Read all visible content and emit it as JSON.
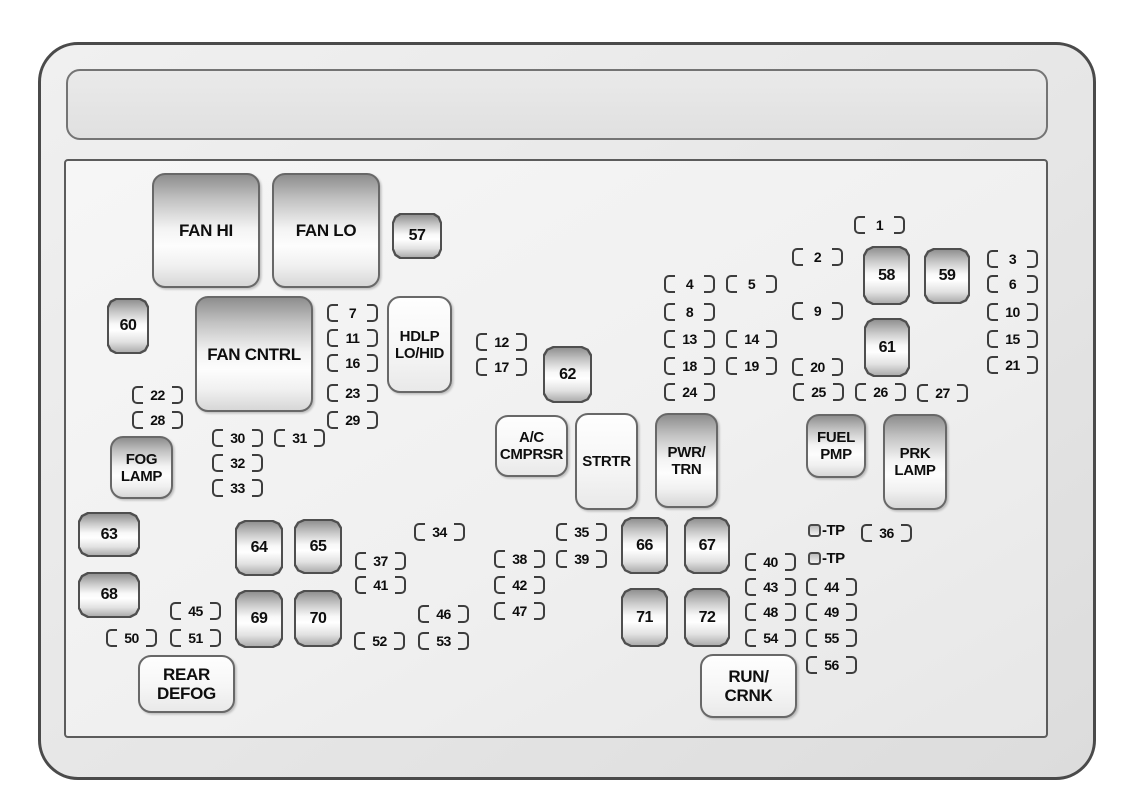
{
  "diagram": {
    "colors": {
      "shell_border": "#4a4a4a",
      "panel_border": "#5c5c5c",
      "bracket": "#3d3d3d",
      "text": "#0e0e0e",
      "shell_fill": "#e6e6e6",
      "panel_fill": "#f0f0f0"
    },
    "relays": [
      {
        "id": "fan-hi",
        "label_lines": [
          "FAN HI"
        ],
        "fill": "gradient",
        "text_size": "lg",
        "x": 152,
        "y": 173,
        "w": 108,
        "h": 115
      },
      {
        "id": "fan-lo",
        "label_lines": [
          "FAN LO"
        ],
        "fill": "gradient",
        "text_size": "lg",
        "x": 272,
        "y": 173,
        "w": 108,
        "h": 115
      },
      {
        "id": "fan-cntrl",
        "label_lines": [
          "FAN CNTRL"
        ],
        "fill": "gradient",
        "text_size": "lg",
        "x": 195,
        "y": 296,
        "w": 118,
        "h": 116
      },
      {
        "id": "hdlp-lo-hid",
        "label_lines": [
          "HDLP",
          "LO/HID"
        ],
        "fill": "light",
        "text_size": "md",
        "x": 387,
        "y": 296,
        "w": 65,
        "h": 97
      },
      {
        "id": "fog-lamp",
        "label_lines": [
          "FOG",
          "LAMP"
        ],
        "fill": "gradient",
        "text_size": "md",
        "x": 110,
        "y": 436,
        "w": 63,
        "h": 63
      },
      {
        "id": "ac-cmprsr",
        "label_lines": [
          "A/C",
          "CMPRSR"
        ],
        "fill": "light",
        "text_size": "md",
        "x": 495,
        "y": 415,
        "w": 73,
        "h": 62
      },
      {
        "id": "strtr",
        "label_lines": [
          "STRTR"
        ],
        "fill": "light",
        "text_size": "md",
        "x": 575,
        "y": 413,
        "w": 63,
        "h": 97
      },
      {
        "id": "pwr-trn",
        "label_lines": [
          "PWR/",
          "TRN"
        ],
        "fill": "gradient",
        "text_size": "md",
        "x": 655,
        "y": 413,
        "w": 63,
        "h": 95
      },
      {
        "id": "fuel-pmp",
        "label_lines": [
          "FUEL",
          "PMP"
        ],
        "fill": "gradient",
        "text_size": "md",
        "x": 806,
        "y": 414,
        "w": 60,
        "h": 64
      },
      {
        "id": "prk-lamp",
        "label_lines": [
          "PRK",
          "LAMP"
        ],
        "fill": "gradient",
        "text_size": "md",
        "x": 883,
        "y": 414,
        "w": 64,
        "h": 96
      },
      {
        "id": "rear-defog",
        "label_lines": [
          "REAR",
          "DEFOG"
        ],
        "fill": "light",
        "text_size": "lg",
        "x": 138,
        "y": 655,
        "w": 97,
        "h": 58
      },
      {
        "id": "run-crnk",
        "label_lines": [
          "RUN/",
          "CRNK"
        ],
        "fill": "light",
        "text_size": "lg",
        "x": 700,
        "y": 654,
        "w": 97,
        "h": 64
      }
    ],
    "fuses": [
      {
        "number": "57",
        "orientation": "h",
        "x": 392,
        "y": 213,
        "w": 50,
        "h": 46
      },
      {
        "number": "58",
        "orientation": "v",
        "x": 863,
        "y": 246,
        "w": 47,
        "h": 59
      },
      {
        "number": "59",
        "orientation": "v",
        "x": 924,
        "y": 248,
        "w": 46,
        "h": 56
      },
      {
        "number": "60",
        "orientation": "v",
        "x": 107,
        "y": 298,
        "w": 42,
        "h": 56
      },
      {
        "number": "61",
        "orientation": "v",
        "x": 864,
        "y": 318,
        "w": 46,
        "h": 59
      },
      {
        "number": "62",
        "orientation": "v",
        "x": 543,
        "y": 346,
        "w": 49,
        "h": 57
      },
      {
        "number": "63",
        "orientation": "h",
        "x": 78,
        "y": 512,
        "w": 62,
        "h": 45
      },
      {
        "number": "64",
        "orientation": "v",
        "x": 235,
        "y": 520,
        "w": 48,
        "h": 56
      },
      {
        "number": "65",
        "orientation": "v",
        "x": 294,
        "y": 519,
        "w": 48,
        "h": 55
      },
      {
        "number": "66",
        "orientation": "v",
        "x": 621,
        "y": 517,
        "w": 47,
        "h": 57
      },
      {
        "number": "67",
        "orientation": "v",
        "x": 684,
        "y": 517,
        "w": 46,
        "h": 57
      },
      {
        "number": "68",
        "orientation": "h",
        "x": 78,
        "y": 572,
        "w": 62,
        "h": 46
      },
      {
        "number": "69",
        "orientation": "v",
        "x": 235,
        "y": 590,
        "w": 48,
        "h": 58
      },
      {
        "number": "70",
        "orientation": "v",
        "x": 294,
        "y": 590,
        "w": 48,
        "h": 57
      },
      {
        "number": "71",
        "orientation": "v",
        "x": 621,
        "y": 588,
        "w": 47,
        "h": 59
      },
      {
        "number": "72",
        "orientation": "v",
        "x": 684,
        "y": 588,
        "w": 46,
        "h": 59
      }
    ],
    "slots": [
      {
        "n": "1",
        "x": 854,
        "y": 216
      },
      {
        "n": "2",
        "x": 792,
        "y": 248
      },
      {
        "n": "3",
        "x": 987,
        "y": 250
      },
      {
        "n": "4",
        "x": 664,
        "y": 275
      },
      {
        "n": "5",
        "x": 726,
        "y": 275
      },
      {
        "n": "6",
        "x": 987,
        "y": 275
      },
      {
        "n": "7",
        "x": 327,
        "y": 304
      },
      {
        "n": "8",
        "x": 664,
        "y": 303
      },
      {
        "n": "9",
        "x": 792,
        "y": 302
      },
      {
        "n": "10",
        "x": 987,
        "y": 303
      },
      {
        "n": "11",
        "x": 327,
        "y": 329
      },
      {
        "n": "12",
        "x": 476,
        "y": 333
      },
      {
        "n": "13",
        "x": 664,
        "y": 330
      },
      {
        "n": "14",
        "x": 726,
        "y": 330
      },
      {
        "n": "15",
        "x": 987,
        "y": 330
      },
      {
        "n": "16",
        "x": 327,
        "y": 354
      },
      {
        "n": "17",
        "x": 476,
        "y": 358
      },
      {
        "n": "18",
        "x": 664,
        "y": 357
      },
      {
        "n": "19",
        "x": 726,
        "y": 357
      },
      {
        "n": "20",
        "x": 792,
        "y": 358
      },
      {
        "n": "21",
        "x": 987,
        "y": 356
      },
      {
        "n": "22",
        "x": 132,
        "y": 386
      },
      {
        "n": "23",
        "x": 327,
        "y": 384
      },
      {
        "n": "24",
        "x": 664,
        "y": 383
      },
      {
        "n": "25",
        "x": 793,
        "y": 383
      },
      {
        "n": "26",
        "x": 855,
        "y": 383
      },
      {
        "n": "27",
        "x": 917,
        "y": 384
      },
      {
        "n": "28",
        "x": 132,
        "y": 411
      },
      {
        "n": "29",
        "x": 327,
        "y": 411
      },
      {
        "n": "30",
        "x": 212,
        "y": 429
      },
      {
        "n": "31",
        "x": 274,
        "y": 429
      },
      {
        "n": "32",
        "x": 212,
        "y": 454
      },
      {
        "n": "33",
        "x": 212,
        "y": 479
      },
      {
        "n": "34",
        "x": 414,
        "y": 523
      },
      {
        "n": "35",
        "x": 556,
        "y": 523
      },
      {
        "n": "36",
        "x": 861,
        "y": 524
      },
      {
        "n": "37",
        "x": 355,
        "y": 552
      },
      {
        "n": "38",
        "x": 494,
        "y": 550
      },
      {
        "n": "39",
        "x": 556,
        "y": 550
      },
      {
        "n": "40",
        "x": 745,
        "y": 553
      },
      {
        "n": "41",
        "x": 355,
        "y": 576
      },
      {
        "n": "42",
        "x": 494,
        "y": 576
      },
      {
        "n": "43",
        "x": 745,
        "y": 578
      },
      {
        "n": "44",
        "x": 806,
        "y": 578
      },
      {
        "n": "45",
        "x": 170,
        "y": 602
      },
      {
        "n": "46",
        "x": 418,
        "y": 605
      },
      {
        "n": "47",
        "x": 494,
        "y": 602
      },
      {
        "n": "48",
        "x": 745,
        "y": 603
      },
      {
        "n": "49",
        "x": 806,
        "y": 603
      },
      {
        "n": "50",
        "x": 106,
        "y": 629
      },
      {
        "n": "51",
        "x": 170,
        "y": 629
      },
      {
        "n": "52",
        "x": 354,
        "y": 632
      },
      {
        "n": "53",
        "x": 418,
        "y": 632
      },
      {
        "n": "54",
        "x": 745,
        "y": 629
      },
      {
        "n": "55",
        "x": 806,
        "y": 629
      },
      {
        "n": "56",
        "x": 806,
        "y": 656
      }
    ],
    "tp_markers": [
      {
        "text": "-TP",
        "x": 808,
        "y": 523
      },
      {
        "text": "-TP",
        "x": 808,
        "y": 551
      }
    ]
  }
}
